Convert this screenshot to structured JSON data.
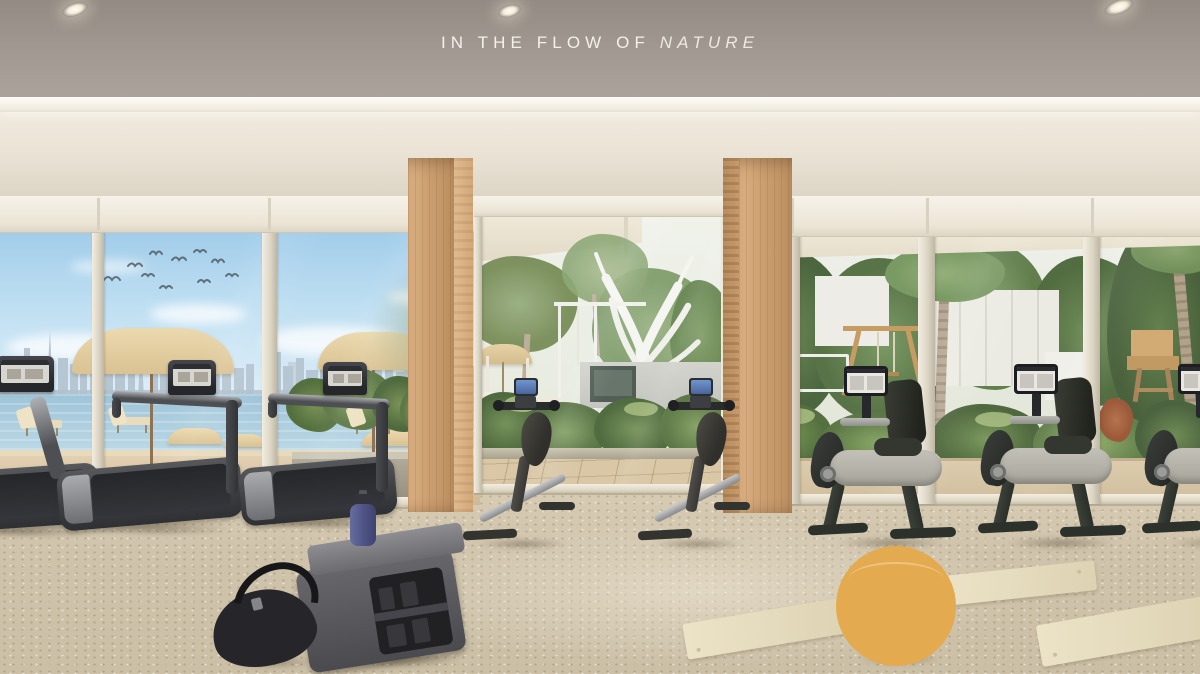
{
  "title": {
    "prefix": "IN THE FLOW OF",
    "emphasis": "NATURE"
  },
  "scene": {
    "type": "architectural-render",
    "room": "residential wellness gym interior",
    "view": "sea, city skyline, pool terrace and palm garden seen through floor-to-ceiling glazing",
    "lighting": [
      "recessed-ceiling-spotlights x3",
      "linear-cove-light"
    ],
    "equipment": [
      {
        "name": "treadmill",
        "count": 3,
        "zone": "left"
      },
      {
        "name": "climb-trainer",
        "count": 2,
        "zone": "center"
      },
      {
        "name": "recumbent-bike",
        "count": 3,
        "zone": "right"
      },
      {
        "name": "storage-bench",
        "count": 1,
        "zone": "foreground-left"
      }
    ],
    "props": [
      "black-duffel-bag",
      "blue-water-bottle",
      "yellow-stability-ball",
      "cream-yoga-mat x3"
    ],
    "exterior_elements": [
      "beach-umbrellas",
      "sun-loungers",
      "city-skyline",
      "flying-birds",
      "white-sculptural-tree",
      "pool-cabana-wall-with-screen",
      "palm-trees",
      "wooden-swing-frame",
      "wooden-lifeguard-chair",
      "planter-hedges"
    ],
    "palette": {
      "ceiling": "#a29a92",
      "cove_light": "#f8f5ee",
      "fascia": "#e9e2d4",
      "wood_pillar": "#cb9f70",
      "floor_carpet": "#cfc3ab",
      "sky": "#a5d0ec",
      "sea": "#a3c8da",
      "foliage": "#6f8e5a",
      "umbrella": "#e0cb9f",
      "ball": "#e4aa4f",
      "bottle": "#565b8e",
      "equipment_dark": "#3f4043"
    }
  }
}
